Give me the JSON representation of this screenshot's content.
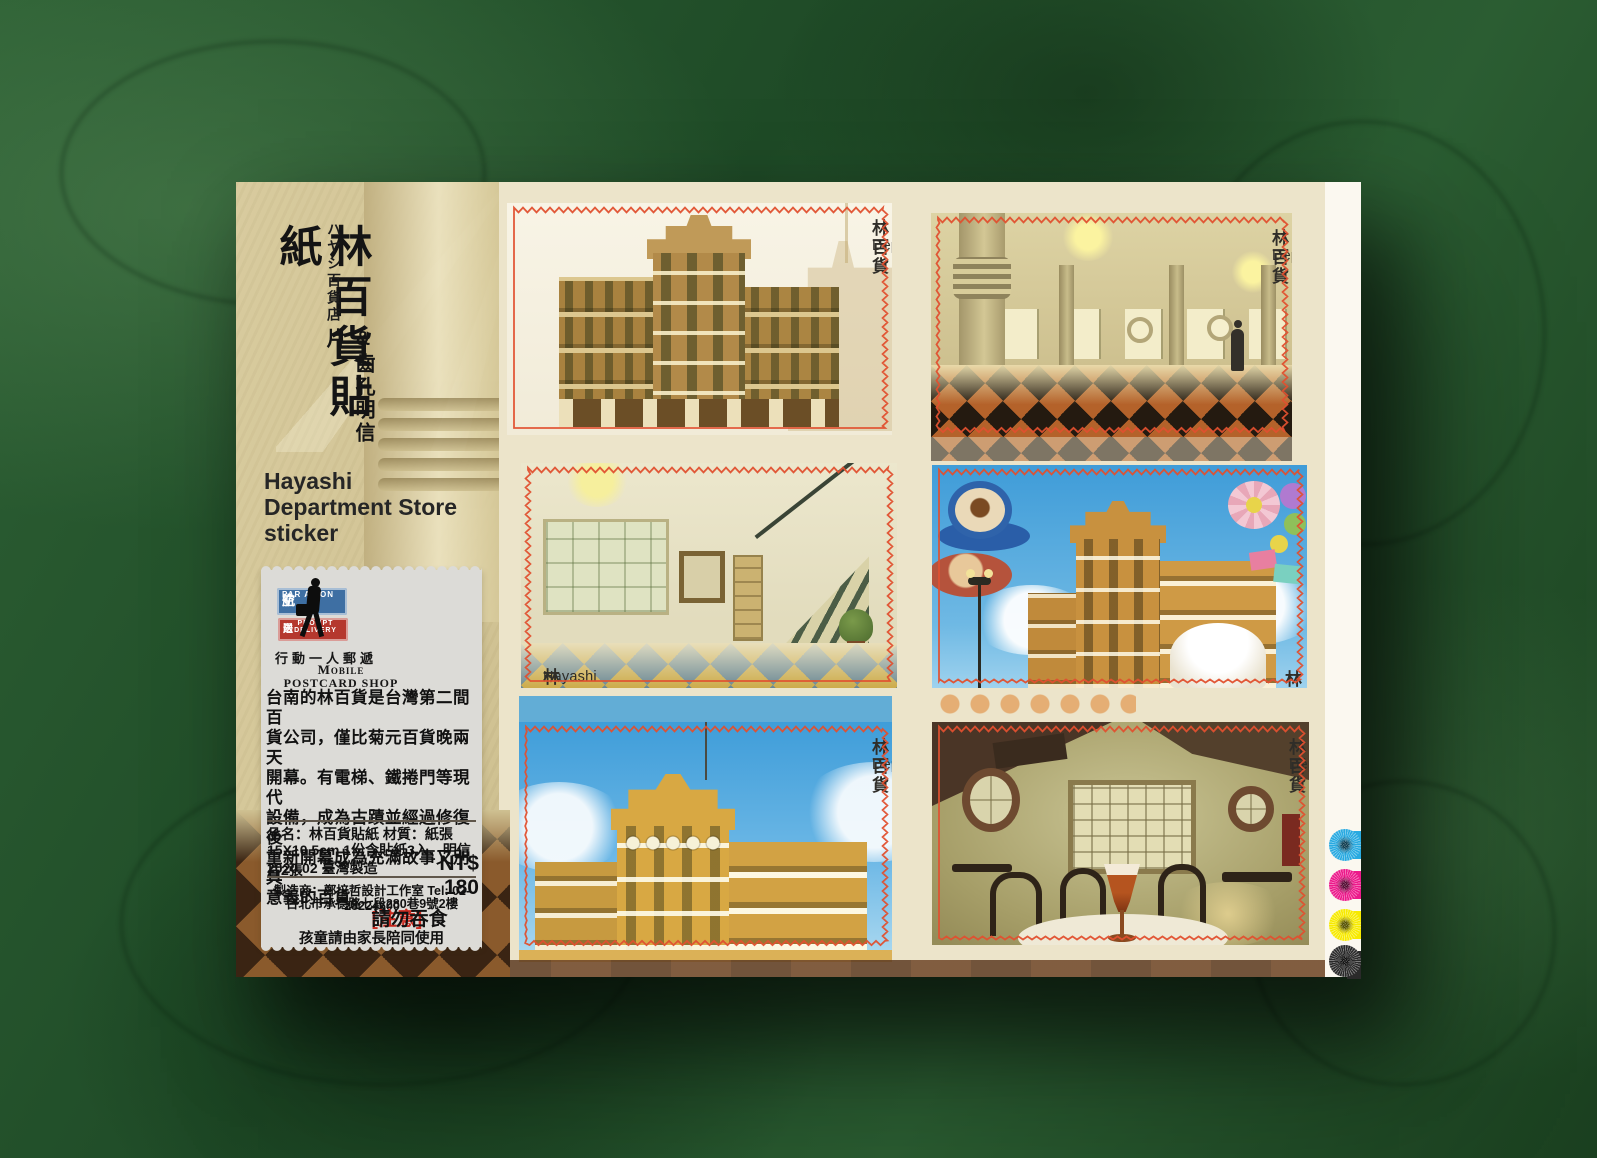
{
  "sheet": {
    "sidebar": {
      "title_vertical": "林百貨貼紙",
      "subtitle_jp_vertical": "ハヤシ百貨店",
      "subtitle_vertical": "&齒孔明信片",
      "title_en_line1": "Hayashi",
      "title_en_line2": "Department Store",
      "title_en_line3": "sticker",
      "logo": {
        "airmail_left": "空",
        "airmail_right": "航",
        "airmail_en": "PAR AVION",
        "delivery_left": "送",
        "delivery_right": "限",
        "delivery_en": "PROMPT DELIVERY",
        "tagline_zh": "行動一人郵遞",
        "shop_line1": "Mobile",
        "shop_line2": "POSTCARD SHOP"
      },
      "description": "台南的林百貨是台灣第二間百\n貨公司，僅比菊元百貨晚兩天\n開幕。有電梯、鐵捲門等現代\n設備，成為古蹟並經過修復後\n重新開幕成為充滿故事又別具\n意義的百貨。",
      "product": {
        "row1": "品名：林百貨貼紙 材質：紙張",
        "row2": "15X10.5cm 1份含貼紙3入、明信片2張",
        "row3": "2020.02  臺灣製造",
        "price": "NT$ 180",
        "maker": "製造商：鄭培哲設計工作室 Tel: 02-28224600",
        "address": "台北市承德路七段280巷9號2樓",
        "warning_tag": "[注意]",
        "warning": "請勿吞食",
        "warning2": "孩童請由家長陪同使用"
      }
    },
    "stamps": [
      {
        "label_zh": "林百貨",
        "label_en": "Hayashi Department Store",
        "label_corner": "top-right"
      },
      {
        "label_zh": "林百貨",
        "label_en": "Hayashi Department Store",
        "label_corner": "top-right"
      },
      {
        "label_zh": "林百貨",
        "label_en": "Hayashi Department Store",
        "label_corner": "bottom-left"
      },
      {
        "label_zh": "林百貨",
        "label_en": "Hayashi Department Store",
        "label_corner": "bottom-right"
      },
      {
        "label_zh": "林百貨",
        "label_en": "Hayashi Department Store",
        "label_corner": "top-right"
      },
      {
        "label_zh": "林百貨",
        "label_en": "Hayashi Department Store",
        "label_corner": "top-right"
      }
    ],
    "print_marks": {
      "cyan": "#29aae1",
      "magenta": "#ec1a8b",
      "yellow": "#f7ea00",
      "black": "#2a2a2a"
    },
    "colors": {
      "perforation_red": "#e0502f",
      "backdrop_green": "#235229",
      "sheet_beige": "#d5c99c"
    }
  }
}
